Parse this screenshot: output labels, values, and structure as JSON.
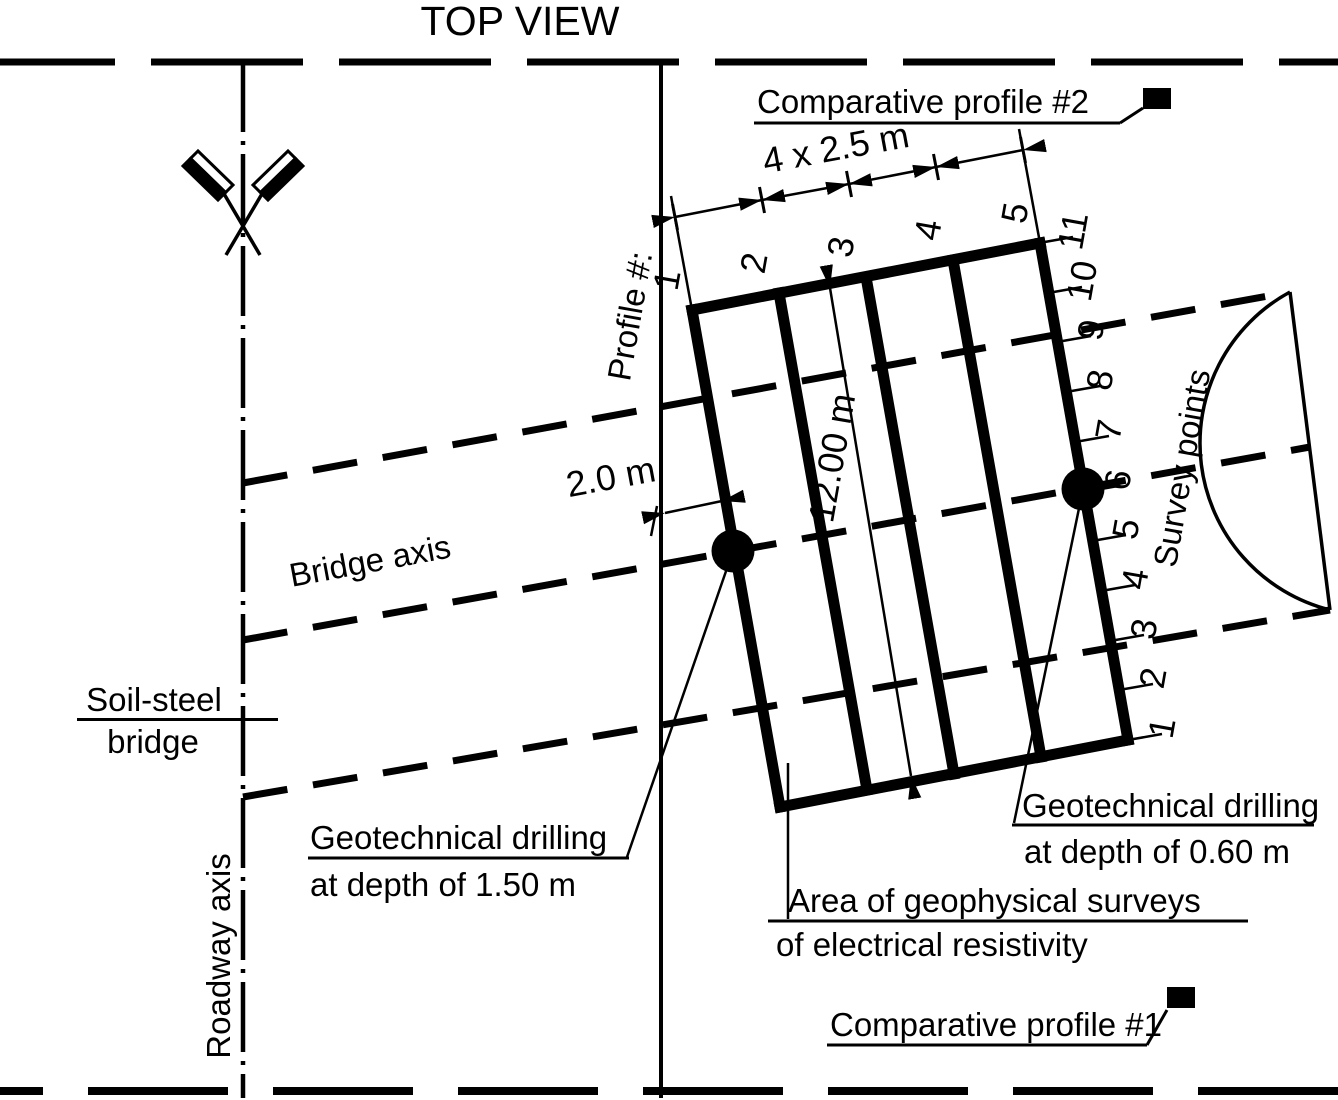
{
  "title": "TOP VIEW",
  "colors": {
    "ink": "#000000",
    "paper": "#ffffff"
  },
  "labels": {
    "profile_axis": "Profile #:",
    "bridge_axis": "Bridge axis",
    "roadway_axis": "Roadway axis",
    "soil_steel_line1": "Soil-steel",
    "soil_steel_line2": "bridge",
    "survey_points": "Survey points",
    "area_line1": "Area of geophysical surveys",
    "area_line2": "of electrical resistivity",
    "comparative_profile_2": "Comparative profile #2",
    "comparative_profile_1": "Comparative profile #1",
    "drilling_deep_line1": "Geotechnical drilling",
    "drilling_deep_line2": "at depth of 1.50 m",
    "drilling_shallow_line1": "Geotechnical drilling",
    "drilling_shallow_line2": "at depth of 0.60 m"
  },
  "dimensions": {
    "profile_spacing": "4 x 2.5 m",
    "profile_length": "12.00 m",
    "edge_offset": "2.0 m"
  },
  "profiles": [
    "1",
    "2",
    "3",
    "4",
    "5"
  ],
  "survey_points": [
    "1",
    "2",
    "3",
    "4",
    "5",
    "6",
    "7",
    "8",
    "9",
    "10",
    "11"
  ]
}
